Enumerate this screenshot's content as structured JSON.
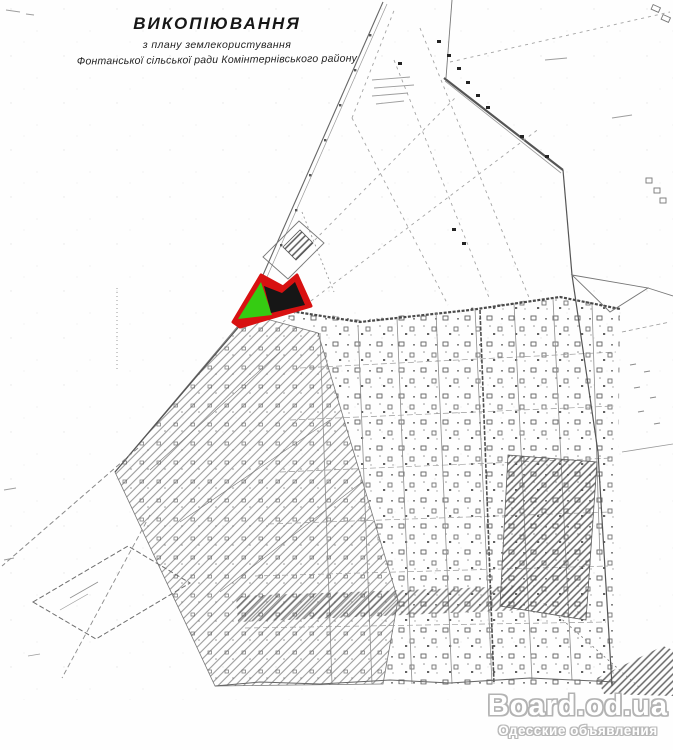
{
  "title": {
    "line1": "ВИКОПІЮВАННЯ",
    "line2": "з плану землекористування",
    "line3": "Фонтанської сільської ради Комінтернівського району"
  },
  "map": {
    "kind": "scanned black-and-white cadastral land-use plan",
    "highlight": {
      "outline_color": "#d81111",
      "green_fill": "#35cc12",
      "dark_fill": "#161616"
    },
    "ink_color": "#555555",
    "paper_color": "#fefefe"
  },
  "watermark": {
    "site": "Board.od.ua",
    "tagline": "Одесские объявления",
    "fill_color": "#ffffff",
    "outline_color": "#b3b3b3"
  }
}
